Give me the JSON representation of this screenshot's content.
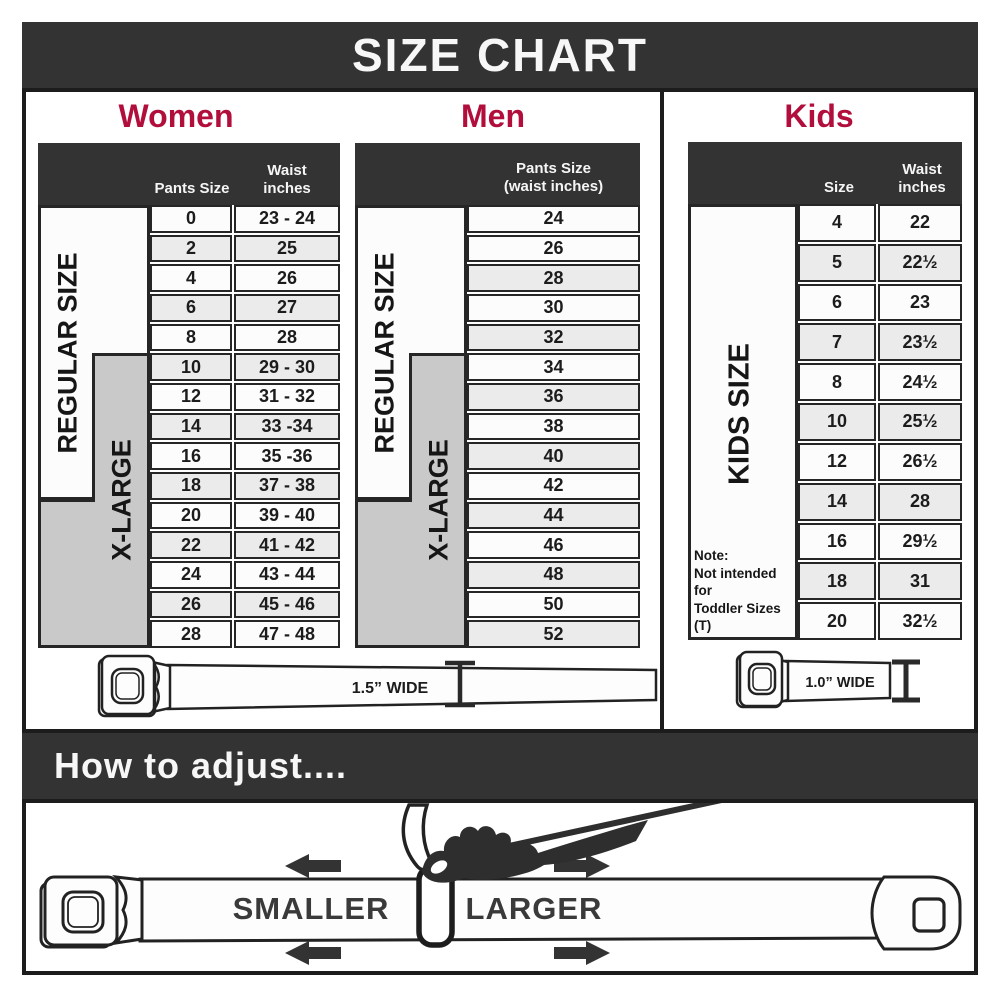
{
  "title": "SIZE CHART",
  "colors": {
    "accent": "#b10e3c",
    "bar": "#333333",
    "label_gray": "#c9c9c9",
    "row_alt": "#ebebeb",
    "border": "#262626"
  },
  "sections": {
    "women": {
      "heading": "Women",
      "regular_label": "REGULAR SIZE",
      "xlarge_label": "X-LARGE",
      "headers": {
        "pants": "Pants Size",
        "waist_line1": "Waist",
        "waist_line2": "inches"
      },
      "rows": [
        {
          "size": "0",
          "waist": "23 - 24",
          "alt": false
        },
        {
          "size": "2",
          "waist": "25",
          "alt": true
        },
        {
          "size": "4",
          "waist": "26",
          "alt": false
        },
        {
          "size": "6",
          "waist": "27",
          "alt": true
        },
        {
          "size": "8",
          "waist": "28",
          "alt": false
        },
        {
          "size": "10",
          "waist": "29 - 30",
          "alt": true
        },
        {
          "size": "12",
          "waist": "31 - 32",
          "alt": false
        },
        {
          "size": "14",
          "waist": "33 -34",
          "alt": true
        },
        {
          "size": "16",
          "waist": "35 -36",
          "alt": false
        },
        {
          "size": "18",
          "waist": "37 - 38",
          "alt": true
        },
        {
          "size": "20",
          "waist": "39 - 40",
          "alt": false
        },
        {
          "size": "22",
          "waist": "41 - 42",
          "alt": true
        },
        {
          "size": "24",
          "waist": "43 - 44",
          "alt": false
        },
        {
          "size": "26",
          "waist": "45 - 46",
          "alt": true
        },
        {
          "size": "28",
          "waist": "47 - 48",
          "alt": false
        }
      ]
    },
    "men": {
      "heading": "Men",
      "regular_label": "REGULAR SIZE",
      "xlarge_label": "X-LARGE",
      "headers": {
        "line1": "Pants Size",
        "line2": "(waist inches)"
      },
      "rows": [
        {
          "size": "24",
          "alt": false
        },
        {
          "size": "26",
          "alt": false
        },
        {
          "size": "28",
          "alt": true
        },
        {
          "size": "30",
          "alt": false
        },
        {
          "size": "32",
          "alt": true
        },
        {
          "size": "34",
          "alt": false
        },
        {
          "size": "36",
          "alt": true
        },
        {
          "size": "38",
          "alt": false
        },
        {
          "size": "40",
          "alt": true
        },
        {
          "size": "42",
          "alt": false
        },
        {
          "size": "44",
          "alt": true
        },
        {
          "size": "46",
          "alt": false
        },
        {
          "size": "48",
          "alt": true
        },
        {
          "size": "50",
          "alt": false
        },
        {
          "size": "52",
          "alt": true
        }
      ]
    },
    "kids": {
      "heading": "Kids",
      "side_label": "KIDS SIZE",
      "headers": {
        "size": "Size",
        "waist_line1": "Waist",
        "waist_line2": "inches"
      },
      "note_lines": [
        "Note:",
        "Not intended for",
        "Toddler Sizes (T)"
      ],
      "rows": [
        {
          "size": "4",
          "waist": "22",
          "alt": false
        },
        {
          "size": "5",
          "waist": "22½",
          "alt": true
        },
        {
          "size": "6",
          "waist": "23",
          "alt": false
        },
        {
          "size": "7",
          "waist": "23½",
          "alt": true
        },
        {
          "size": "8",
          "waist": "24½",
          "alt": false
        },
        {
          "size": "10",
          "waist": "25½",
          "alt": true
        },
        {
          "size": "12",
          "waist": "26½",
          "alt": false
        },
        {
          "size": "14",
          "waist": "28",
          "alt": true
        },
        {
          "size": "16",
          "waist": "29½",
          "alt": false
        },
        {
          "size": "18",
          "waist": "31",
          "alt": true
        },
        {
          "size": "20",
          "waist": "32½",
          "alt": false
        }
      ]
    }
  },
  "belts": {
    "adult_width": "1.5” WIDE",
    "kids_width": "1.0” WIDE"
  },
  "adjust": {
    "heading": "How to adjust....",
    "smaller": "SMALLER",
    "larger": "LARGER"
  }
}
